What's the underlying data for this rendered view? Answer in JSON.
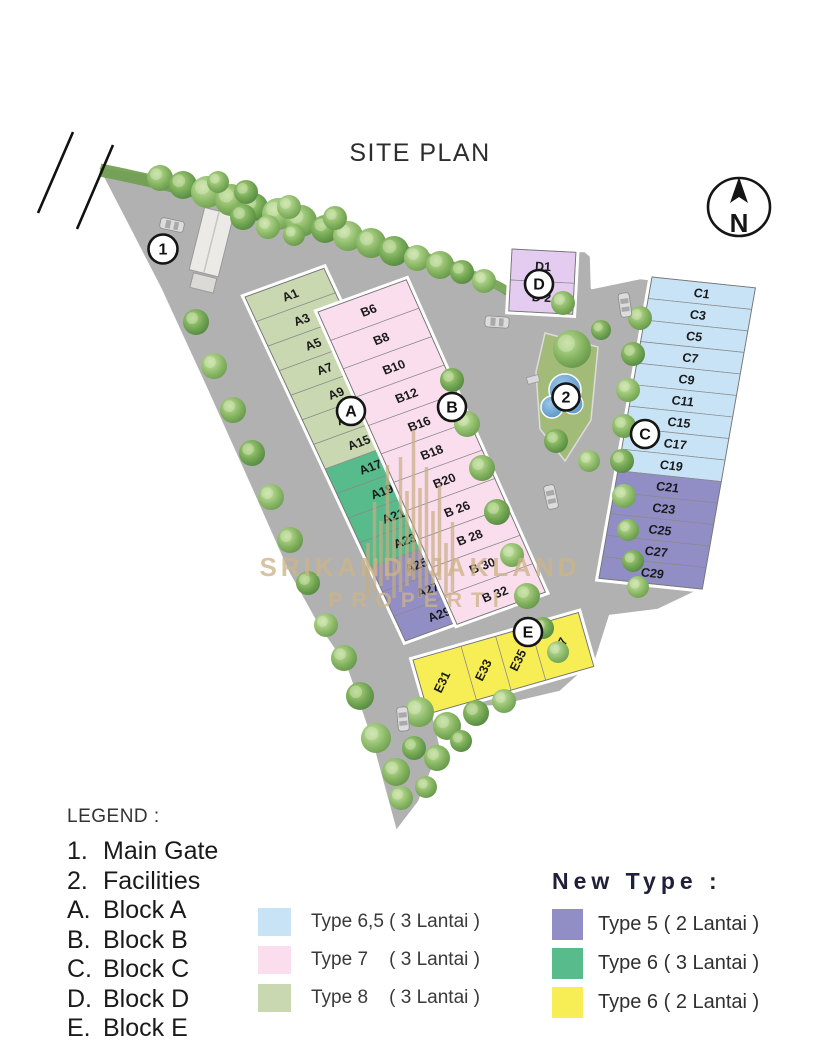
{
  "title": "SITE PLAN",
  "compass": {
    "label": "N"
  },
  "watermark": {
    "line1": "SRIKANDI JAKLAND",
    "line2": "PROPERTI"
  },
  "markers": {
    "gate": "1",
    "facilities": "2",
    "A": "A",
    "B": "B",
    "C": "C",
    "D": "D",
    "E": "E"
  },
  "colors": {
    "type65": "#c8e3f6",
    "type7": "#fadeee",
    "type8": "#cad8b1",
    "type5": "#908ec4",
    "type6_3lt": "#58bb8c",
    "type6_2lt": "#f7ee55",
    "blockD": "#e3ccf0",
    "road": "#b1b1b1",
    "grass": "#6f9e4f",
    "pool": "#4d8ec2",
    "watermark_gold": "#cdb488"
  },
  "blocks": {
    "A": {
      "name": "Block A",
      "lots": [
        {
          "label": "A1",
          "type": "type8"
        },
        {
          "label": "A3",
          "type": "type8"
        },
        {
          "label": "A5",
          "type": "type8"
        },
        {
          "label": "A7",
          "type": "type8"
        },
        {
          "label": "A9",
          "type": "type8"
        },
        {
          "label": "A11",
          "type": "type8"
        },
        {
          "label": "A15",
          "type": "type8"
        },
        {
          "label": "A17",
          "type": "type6_3lt"
        },
        {
          "label": "A19",
          "type": "type6_3lt"
        },
        {
          "label": "A21",
          "type": "type6_3lt"
        },
        {
          "label": "A23",
          "type": "type6_3lt"
        },
        {
          "label": "A25",
          "type": "type5"
        },
        {
          "label": "A27",
          "type": "type5"
        },
        {
          "label": "A29",
          "type": "type5"
        }
      ]
    },
    "B": {
      "name": "Block B",
      "lots": [
        {
          "label": "B6",
          "type": "type7"
        },
        {
          "label": "B8",
          "type": "type7"
        },
        {
          "label": "B10",
          "type": "type7"
        },
        {
          "label": "B12",
          "type": "type7"
        },
        {
          "label": "B16",
          "type": "type7"
        },
        {
          "label": "B18",
          "type": "type7"
        },
        {
          "label": "B20",
          "type": "type7"
        },
        {
          "label": "B 26",
          "type": "type7"
        },
        {
          "label": "B 28",
          "type": "type7"
        },
        {
          "label": "B 30",
          "type": "type7"
        },
        {
          "label": "B 32",
          "type": "type7"
        }
      ]
    },
    "C": {
      "name": "Block C",
      "lots": [
        {
          "label": "C1",
          "type": "type65"
        },
        {
          "label": "C3",
          "type": "type65"
        },
        {
          "label": "C5",
          "type": "type65"
        },
        {
          "label": "C7",
          "type": "type65"
        },
        {
          "label": "C9",
          "type": "type65"
        },
        {
          "label": "C11",
          "type": "type65"
        },
        {
          "label": "C15",
          "type": "type65"
        },
        {
          "label": "C17",
          "type": "type65"
        },
        {
          "label": "C19",
          "type": "type65"
        },
        {
          "label": "C21",
          "type": "type5"
        },
        {
          "label": "C23",
          "type": "type5"
        },
        {
          "label": "C25",
          "type": "type5"
        },
        {
          "label": "C27",
          "type": "type5"
        },
        {
          "label": "C29",
          "type": "type5"
        }
      ]
    },
    "D": {
      "name": "Block D",
      "lots": [
        {
          "label": "D1",
          "type": "blockD"
        },
        {
          "label": "D 2",
          "type": "blockD"
        }
      ]
    },
    "E": {
      "name": "Block E",
      "lots": [
        {
          "label": "E31",
          "type": "type6_2lt"
        },
        {
          "label": "E33",
          "type": "type6_2lt"
        },
        {
          "label": "E35",
          "type": "type6_2lt"
        },
        {
          "label": "E37",
          "type": "type6_2lt"
        }
      ]
    }
  },
  "legend": {
    "title": "LEGEND :",
    "items": [
      {
        "key": "1.",
        "label": "Main Gate"
      },
      {
        "key": "2.",
        "label": "Facilities"
      },
      {
        "key": "A.",
        "label": "Block A"
      },
      {
        "key": "B.",
        "label": "Block B"
      },
      {
        "key": "C.",
        "label": "Block C"
      },
      {
        "key": "D.",
        "label": "Block D"
      },
      {
        "key": "E.",
        "label": "Block E"
      }
    ]
  },
  "type_legend": {
    "items": [
      {
        "type": "type65",
        "label": "Type 6,5 ( 3 Lantai )"
      },
      {
        "type": "type7",
        "label": "Type 7    ( 3 Lantai )"
      },
      {
        "type": "type8",
        "label": "Type 8    ( 3 Lantai )"
      }
    ]
  },
  "new_type_legend": {
    "title": "New Type :",
    "items": [
      {
        "type": "type5",
        "label": "Type 5 ( 2 Lantai )"
      },
      {
        "type": "type6_3lt",
        "label": "Type 6 ( 3 Lantai )"
      },
      {
        "type": "type6_2lt",
        "label": "Type 6 ( 2 Lantai )"
      }
    ]
  }
}
